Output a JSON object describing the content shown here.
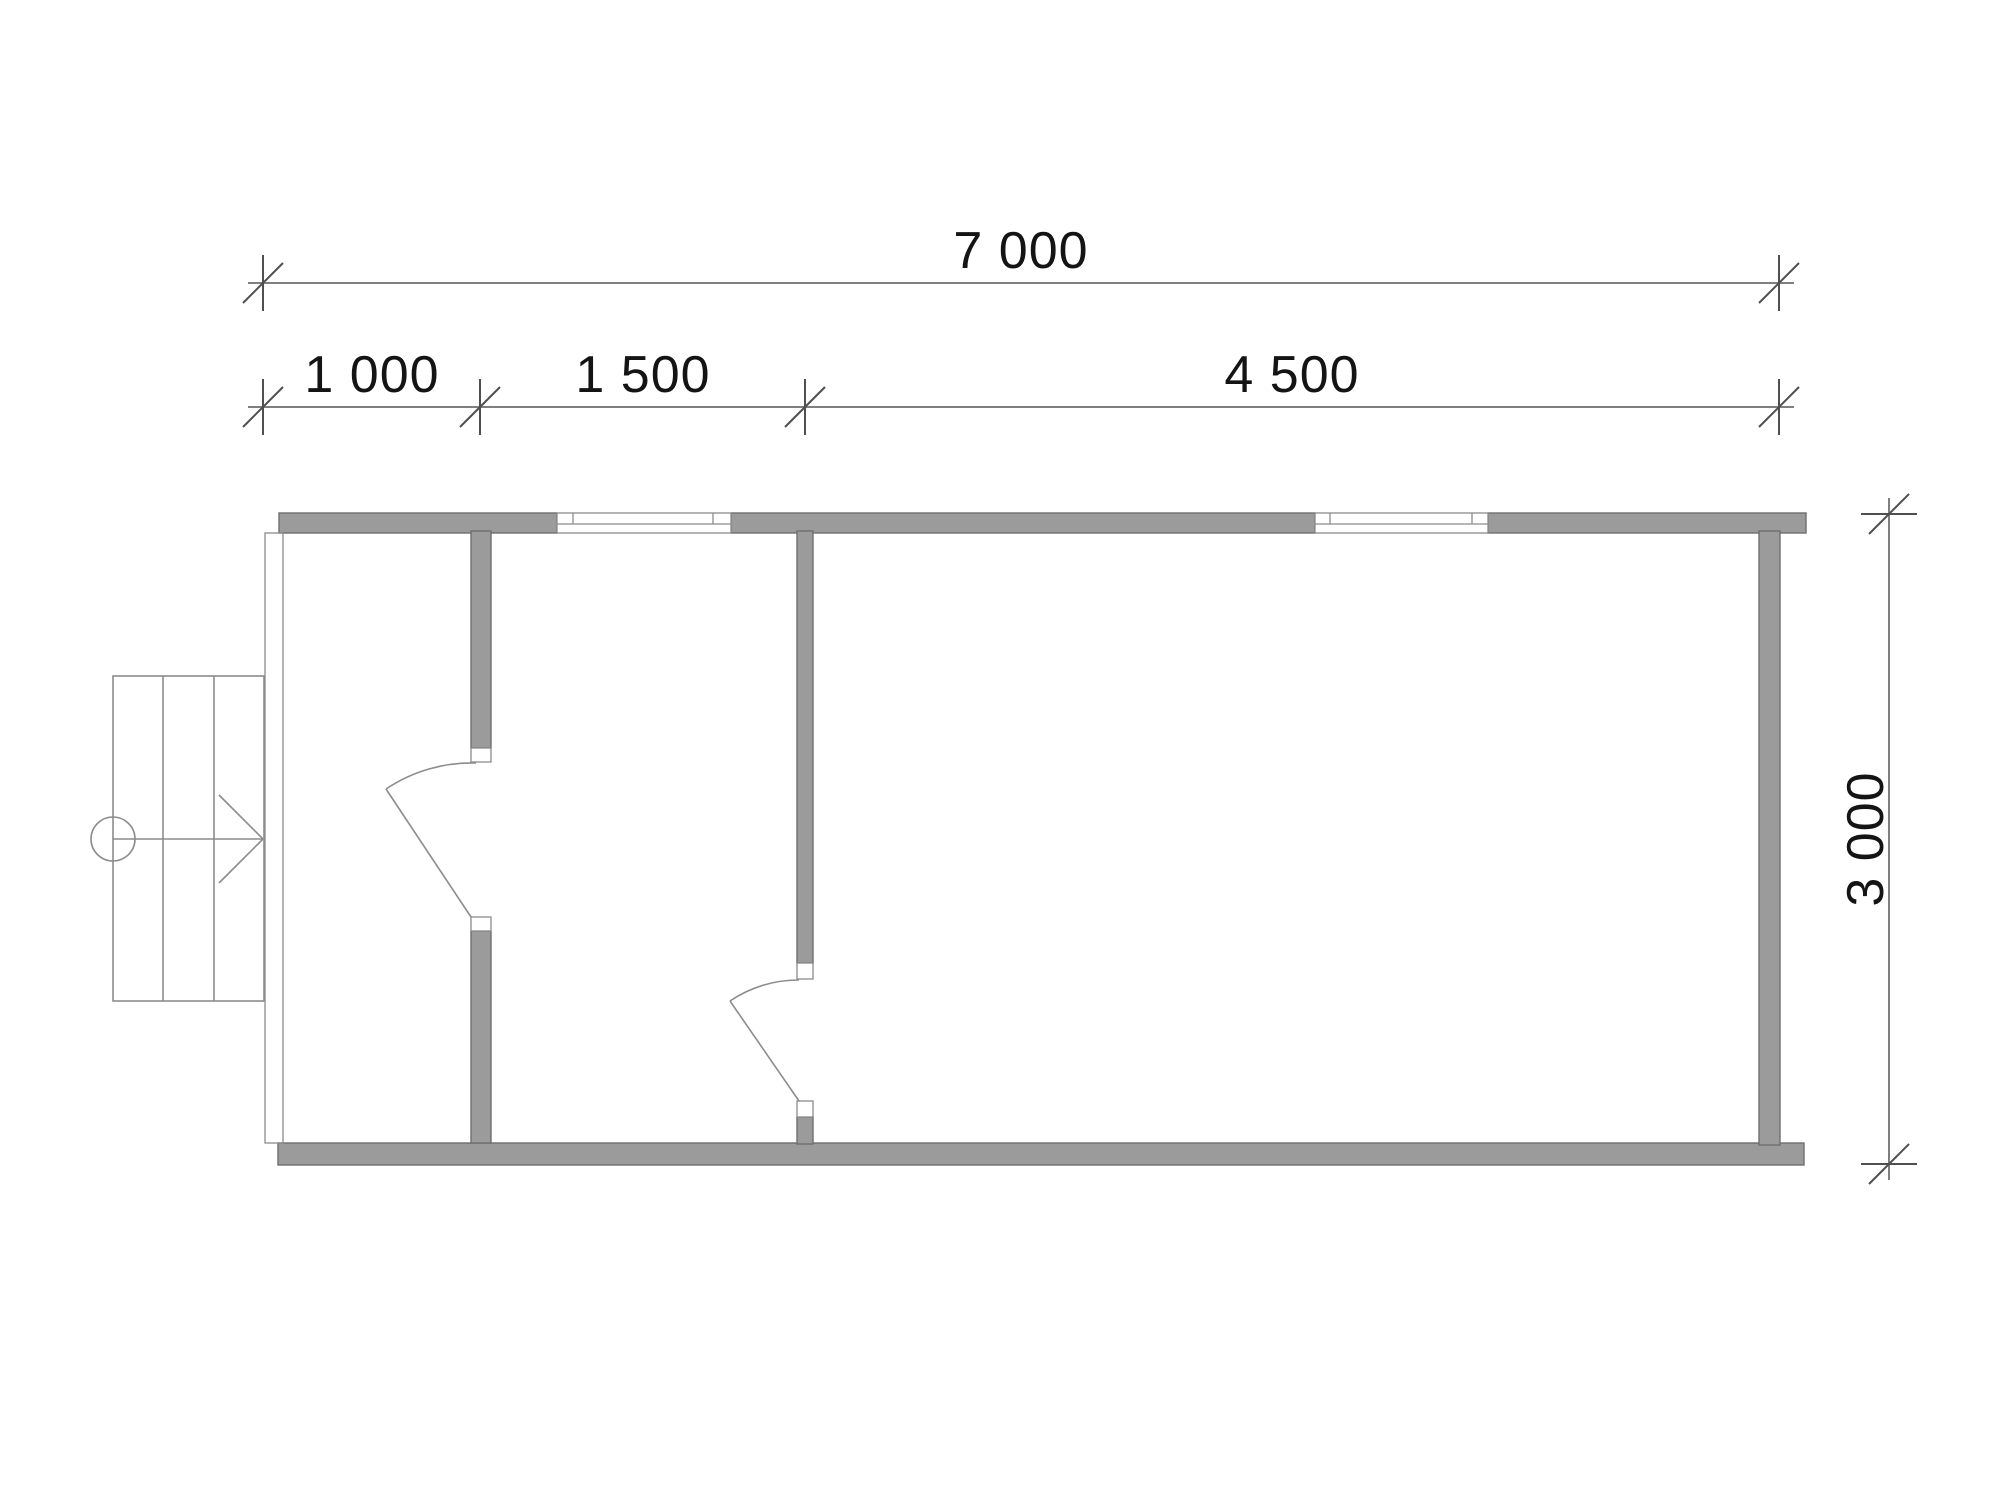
{
  "drawing": {
    "type": "architectural-floor-plan",
    "background": "#ffffff",
    "colors": {
      "wall_fill": "#9b9b9b",
      "wall_outline": "#6e6e6e",
      "thin_line": "#8c8c8c",
      "dimension_line": "#7f7f7f",
      "tick": "#4f4f4f",
      "text": "#141414",
      "opening_fill": "#ffffff"
    },
    "dimensions": {
      "overall_width_mm": "7 000",
      "segment_1_mm": "1 000",
      "segment_2_mm": "1 500",
      "segment_3_mm": "4 500",
      "overall_depth_mm": "3 000"
    }
  }
}
